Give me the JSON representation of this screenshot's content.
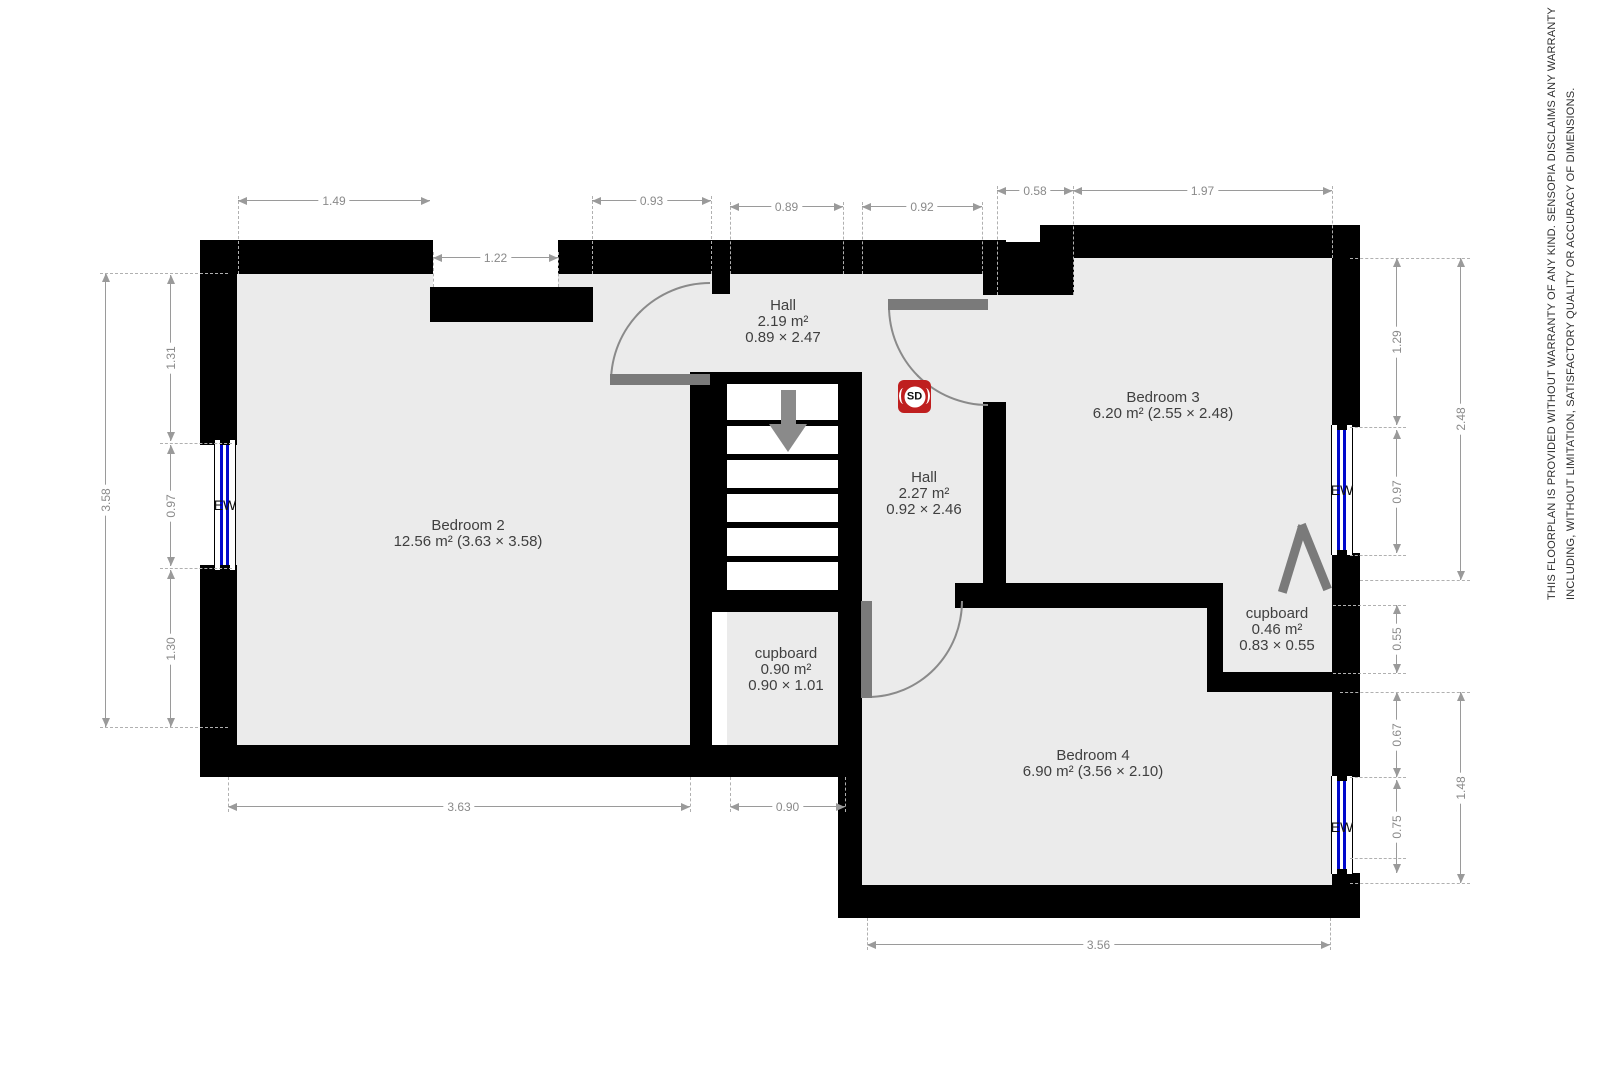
{
  "disclaimer": {
    "line1": "THIS FLOORPLAN IS PROVIDED WITHOUT WARRANTY OF ANY KIND. SENSOPIA DISCLAIMS ANY WARRANTY",
    "line2": "INCLUDING, WITHOUT LIMITATION, SATISFACTORY QUALITY OR ACCURACY OF DIMENSIONS."
  },
  "plan": {
    "colors": {
      "wall": "#000000",
      "floor": "#ebebeb",
      "door": "#7a7a7a",
      "door_arc": "#8a8a8a",
      "window_glass": "#0008cc",
      "dim_line": "#9a9a9a",
      "dim_text": "#8a8a8a",
      "dash": "#b0b0b0",
      "room_text": "#3f3f3f",
      "smoke_detector": "#bf1f1f",
      "stair_arrow": "#8a8a8a"
    },
    "rooms": [
      {
        "cx": 468,
        "top": 518,
        "lines": [
          "Bedroom 2",
          "12.56 m² (3.63 × 3.58)"
        ]
      },
      {
        "cx": 783,
        "top": 298,
        "lines": [
          "Hall",
          "2.19 m²",
          "0.89 × 2.47"
        ]
      },
      {
        "cx": 924,
        "top": 470,
        "lines": [
          "Hall",
          "2.27 m²",
          "0.92 × 2.46"
        ]
      },
      {
        "cx": 1163,
        "top": 390,
        "lines": [
          "Bedroom 3",
          "6.20 m² (2.55 × 2.48)"
        ]
      },
      {
        "cx": 1093,
        "top": 748,
        "lines": [
          "Bedroom 4",
          "6.90 m² (3.56 × 2.10)"
        ]
      },
      {
        "cx": 786,
        "top": 646,
        "lines": [
          "cupboard",
          "0.90 m²",
          "0.90 × 1.01"
        ]
      },
      {
        "cx": 1277,
        "top": 606,
        "lines": [
          "cupboard",
          "0.46 m²",
          "0.83 × 0.55"
        ]
      }
    ],
    "floors": [
      [
        228,
        274,
        462,
        471
      ],
      [
        712,
        274,
        271,
        98
      ],
      [
        862,
        372,
        121,
        211
      ],
      [
        1006,
        258,
        326,
        325
      ],
      [
        1223,
        583,
        109,
        89
      ],
      [
        862,
        608,
        470,
        277
      ],
      [
        727,
        612,
        118,
        133
      ],
      [
        690,
        274,
        22,
        98
      ],
      [
        983,
        295,
        23,
        107
      ],
      [
        862,
        583,
        93,
        25
      ]
    ],
    "white_cuts": [
      [
        433,
        240,
        125,
        47
      ],
      [
        1015,
        242,
        25,
        16
      ]
    ],
    "walls": [
      [
        200,
        240,
        233,
        34
      ],
      [
        430,
        287,
        163,
        35
      ],
      [
        558,
        240,
        448,
        34
      ],
      [
        983,
        242,
        91,
        53
      ],
      [
        1040,
        225,
        34,
        70
      ],
      [
        1074,
        225,
        286,
        33
      ],
      [
        200,
        240,
        37,
        205
      ],
      [
        200,
        565,
        37,
        212
      ],
      [
        200,
        745,
        662,
        32
      ],
      [
        690,
        372,
        22,
        405
      ],
      [
        712,
        274,
        18,
        20
      ],
      [
        712,
        372,
        15,
        240
      ],
      [
        838,
        372,
        24,
        405
      ],
      [
        712,
        372,
        126,
        12
      ],
      [
        712,
        590,
        150,
        22
      ],
      [
        838,
        583,
        24,
        335
      ],
      [
        955,
        583,
        268,
        25
      ],
      [
        983,
        402,
        23,
        181
      ],
      [
        1207,
        585,
        16,
        107
      ],
      [
        1207,
        672,
        126,
        20
      ],
      [
        1332,
        225,
        28,
        202
      ],
      [
        1332,
        553,
        28,
        224
      ],
      [
        1332,
        873,
        28,
        45
      ],
      [
        838,
        885,
        522,
        33
      ]
    ],
    "stairs": {
      "treads_area": [
        727,
        384,
        111,
        206
      ],
      "separator_ys": [
        420,
        454,
        488,
        522,
        556
      ],
      "separator_h": 6,
      "arrow_shaft": [
        781,
        390,
        15,
        34
      ],
      "arrow_head": {
        "x": 769,
        "y": 424,
        "half_w": 19,
        "h": 28
      }
    },
    "windows": [
      {
        "box": [
          214,
          440,
          22,
          130
        ],
        "label": "EW",
        "label_cx": 225,
        "label_cy": 505
      },
      {
        "box": [
          1331,
          425,
          22,
          130
        ],
        "label": "EW",
        "label_cx": 1342,
        "label_cy": 490
      },
      {
        "box": [
          1331,
          776,
          22,
          98
        ],
        "label": "EW",
        "label_cx": 1342,
        "label_cy": 827
      }
    ],
    "doors": [
      {
        "arc": [
          610,
          282,
          100,
          100
        ],
        "corner": "tl",
        "leaf": [
          610,
          374,
          100,
          11
        ]
      },
      {
        "arc": [
          888,
          306,
          100,
          100
        ],
        "corner": "bl",
        "leaf": [
          888,
          299,
          100,
          11
        ]
      },
      {
        "arc": [
          868,
          601,
          95,
          97
        ],
        "corner": "br",
        "leaf": [
          861,
          601,
          11,
          97
        ]
      }
    ],
    "folding_door_strokes": [
      {
        "x": 1288,
        "y": 524,
        "w": 9,
        "h": 70,
        "rot": 17
      },
      {
        "x": 1310,
        "y": 522,
        "w": 9,
        "h": 70,
        "rot": -22
      }
    ],
    "smoke_detector": {
      "box": [
        898,
        380,
        33,
        33
      ],
      "label": "SD"
    },
    "dims_h": [
      {
        "x1": 238,
        "x2": 430,
        "y": 200,
        "v": "1.49"
      },
      {
        "x1": 433,
        "x2": 558,
        "y": 257,
        "v": "1.22"
      },
      {
        "x1": 592,
        "x2": 711,
        "y": 200,
        "v": "0.93"
      },
      {
        "x1": 730,
        "x2": 843,
        "y": 206,
        "v": "0.89"
      },
      {
        "x1": 862,
        "x2": 982,
        "y": 206,
        "v": "0.92"
      },
      {
        "x1": 997,
        "x2": 1073,
        "y": 190,
        "v": "0.58"
      },
      {
        "x1": 1073,
        "x2": 1332,
        "y": 190,
        "v": "1.97"
      },
      {
        "x1": 228,
        "x2": 690,
        "y": 806,
        "v": "3.63"
      },
      {
        "x1": 730,
        "x2": 845,
        "y": 806,
        "v": "0.90"
      },
      {
        "x1": 867,
        "x2": 1330,
        "y": 944,
        "v": "3.56"
      }
    ],
    "dims_v": [
      {
        "x": 105,
        "y1": 273,
        "y2": 727,
        "v": "3.58"
      },
      {
        "x": 170,
        "y1": 275,
        "y2": 441,
        "v": "1.31"
      },
      {
        "x": 170,
        "y1": 445,
        "y2": 566,
        "v": "0.97"
      },
      {
        "x": 170,
        "y1": 570,
        "y2": 727,
        "v": "1.30"
      },
      {
        "x": 1396,
        "y1": 258,
        "y2": 425,
        "v": "1.29"
      },
      {
        "x": 1396,
        "y1": 430,
        "y2": 553,
        "v": "0.97"
      },
      {
        "x": 1460,
        "y1": 258,
        "y2": 580,
        "v": "2.48"
      },
      {
        "x": 1396,
        "y1": 605,
        "y2": 673,
        "v": "0.55"
      },
      {
        "x": 1396,
        "y1": 692,
        "y2": 777,
        "v": "0.67"
      },
      {
        "x": 1396,
        "y1": 780,
        "y2": 873,
        "v": "0.75"
      },
      {
        "x": 1460,
        "y1": 692,
        "y2": 883,
        "v": "1.48"
      }
    ],
    "dashes_v": [
      [
        238,
        196,
        274
      ],
      [
        433,
        252,
        287
      ],
      [
        558,
        252,
        287
      ],
      [
        592,
        196,
        274
      ],
      [
        711,
        196,
        274
      ],
      [
        730,
        202,
        274
      ],
      [
        843,
        202,
        274
      ],
      [
        862,
        202,
        274
      ],
      [
        982,
        202,
        274
      ],
      [
        997,
        186,
        295
      ],
      [
        1073,
        186,
        295
      ],
      [
        1332,
        186,
        258
      ],
      [
        228,
        777,
        812
      ],
      [
        690,
        777,
        812
      ],
      [
        730,
        777,
        812
      ],
      [
        845,
        777,
        812
      ],
      [
        867,
        918,
        950
      ],
      [
        1330,
        918,
        950
      ]
    ],
    "dashes_h": [
      [
        100,
        228,
        273
      ],
      [
        160,
        232,
        443
      ],
      [
        160,
        232,
        568
      ],
      [
        100,
        228,
        727
      ],
      [
        1350,
        1470,
        258
      ],
      [
        1350,
        1406,
        427
      ],
      [
        1350,
        1406,
        555
      ],
      [
        1360,
        1470,
        580
      ],
      [
        1333,
        1406,
        605
      ],
      [
        1333,
        1406,
        673
      ],
      [
        1340,
        1470,
        692
      ],
      [
        1350,
        1406,
        777
      ],
      [
        1350,
        1406,
        858
      ],
      [
        1350,
        1470,
        883
      ]
    ],
    "disclaimer_pos": {
      "line1": [
        1546,
        600
      ],
      "line2": [
        1565,
        600
      ]
    }
  }
}
